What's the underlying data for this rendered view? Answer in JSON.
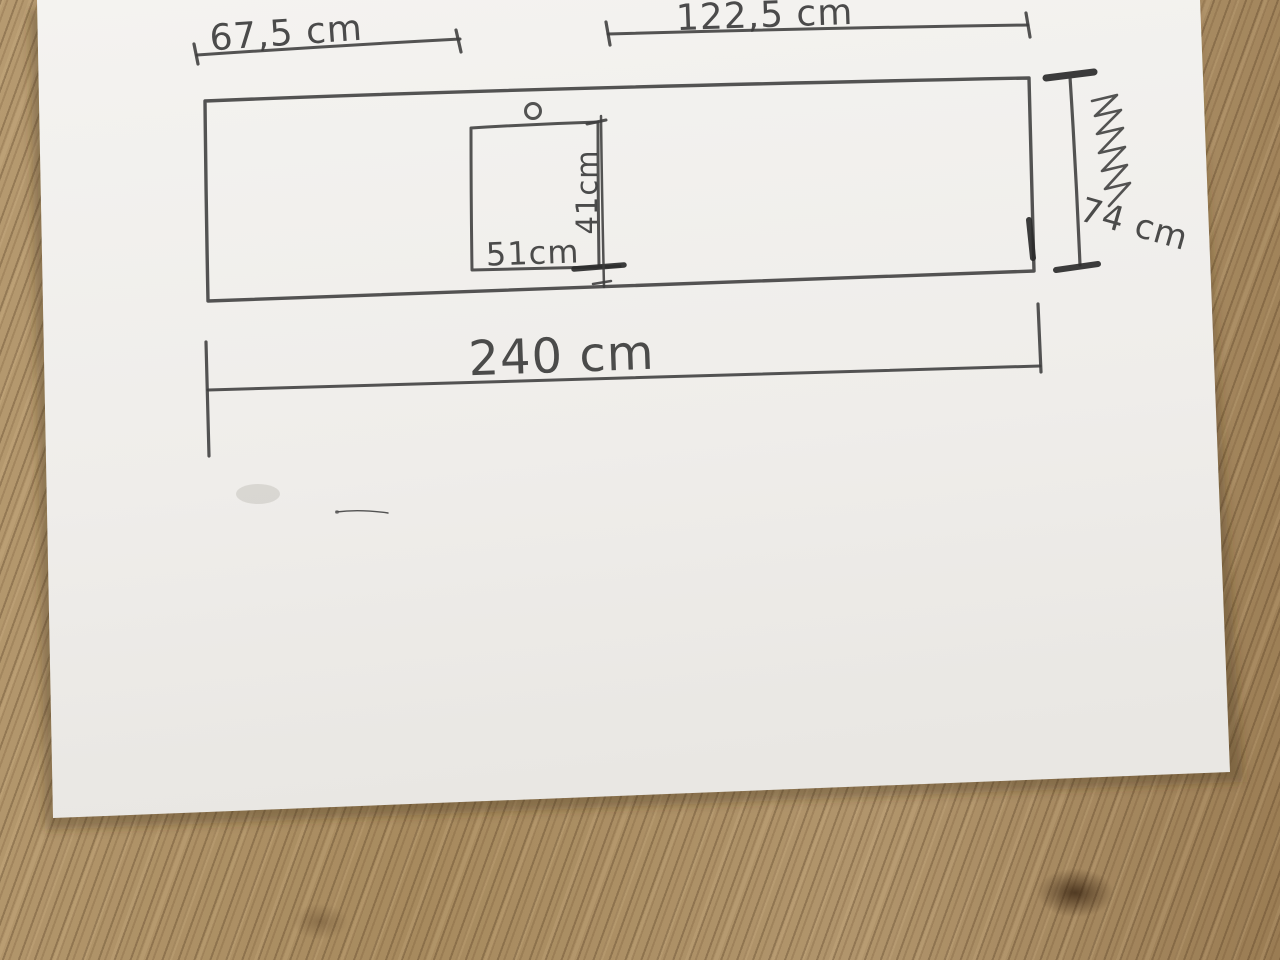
{
  "sketch": {
    "labels": {
      "top_left_width": "67,5 cm",
      "top_right_width": "122,5 cm",
      "total_width": "240 cm",
      "side_height": "74 cm",
      "cutout_width": "51cm",
      "cutout_height": "41cm"
    },
    "colors": {
      "pencil": "#3c3c3c",
      "paper": "#f1efec",
      "wood_light": "#b69a70",
      "wood_dark": "#7d6040"
    }
  }
}
